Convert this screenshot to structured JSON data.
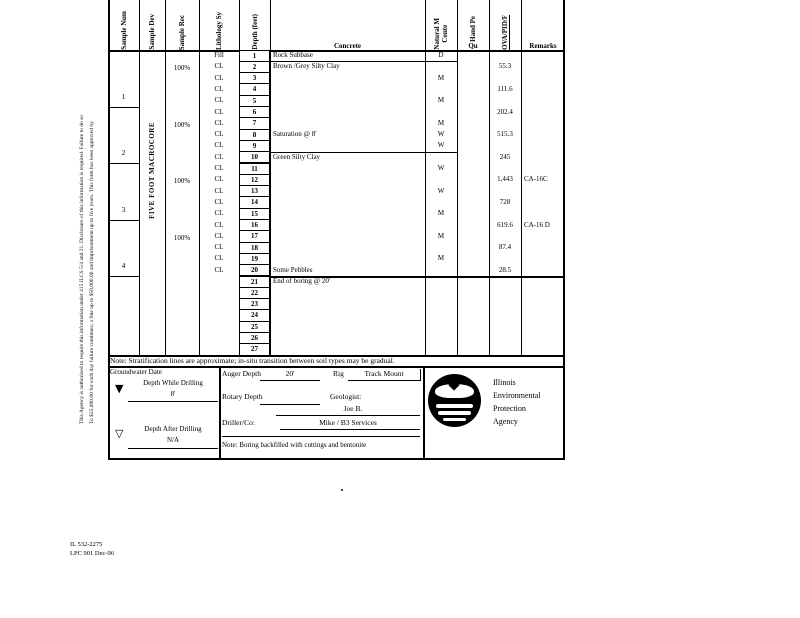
{
  "page": {
    "disclaimer_line1": "This Agency is authorized to require this information under 415 ILCS 5/4 and 21.  Disclosure of this information is required.  Failure to do so",
    "disclaimer_line2": "To $25,000.00 for each day failure continues; a fine up to $50,000.00 and imprisonment up to five years.  This form has been approved by",
    "footer_line1": "IL 532-2275",
    "footer_line2": "LPC 901 Dec-96"
  },
  "table": {
    "headers": {
      "sample_num": "Sample Num",
      "sample_dev": "Sample Dev",
      "sample_rec": "Sample Rec",
      "lithology": "Lithology Sy",
      "depth": "Depth (feet)",
      "surface_material": "Concrete",
      "moisture": "Natural M\nConte",
      "hand_pen": "Hand Pe",
      "qu": "Qu",
      "ova": "OVA/PID/F",
      "remarks": "Remarks"
    },
    "sample_dev_label": "FIVE FOOT MACROCORE",
    "samples": [
      {
        "num": "1",
        "rec": "100%",
        "start_row": 1,
        "end_row": 5
      },
      {
        "num": "2",
        "rec": "100%",
        "start_row": 6,
        "end_row": 10
      },
      {
        "num": "3",
        "rec": "100%",
        "start_row": 11,
        "end_row": 15
      },
      {
        "num": "4",
        "rec": "100%",
        "start_row": 16,
        "end_row": 20
      }
    ],
    "rows": [
      {
        "depth": "1",
        "lith": "Fill",
        "desc": "Rock Subbase",
        "moisture": "D",
        "ova": "",
        "remark": ""
      },
      {
        "depth": "2",
        "lith": "CL",
        "desc": "Brown /Grey Silty Clay",
        "moisture": "",
        "ova": "55.3",
        "remark": ""
      },
      {
        "depth": "3",
        "lith": "CL",
        "desc": "",
        "moisture": "M",
        "ova": "",
        "remark": ""
      },
      {
        "depth": "4",
        "lith": "CL",
        "desc": "",
        "moisture": "",
        "ova": "111.6",
        "remark": ""
      },
      {
        "depth": "5",
        "lith": "CL",
        "desc": "",
        "moisture": "M",
        "ova": "",
        "remark": ""
      },
      {
        "depth": "6",
        "lith": "CL",
        "desc": "",
        "moisture": "",
        "ova": "202.4",
        "remark": ""
      },
      {
        "depth": "7",
        "lith": "CL",
        "desc": "",
        "moisture": "M",
        "ova": "",
        "remark": ""
      },
      {
        "depth": "8",
        "lith": "CL",
        "desc": "Saturation @ 8'",
        "moisture": "W",
        "ova": "515.3",
        "remark": ""
      },
      {
        "depth": "9",
        "lith": "CL",
        "desc": "",
        "moisture": "W",
        "ova": "",
        "remark": ""
      },
      {
        "depth": "10",
        "lith": "CL",
        "desc": "Green Silty Clay",
        "moisture": "",
        "ova": "245",
        "remark": ""
      },
      {
        "depth": "11",
        "lith": "CL",
        "desc": "",
        "moisture": "W",
        "ova": "",
        "remark": ""
      },
      {
        "depth": "12",
        "lith": "CL",
        "desc": "",
        "moisture": "",
        "ova": "1,443",
        "remark": "CA-16C"
      },
      {
        "depth": "13",
        "lith": "CL",
        "desc": "",
        "moisture": "W",
        "ova": "",
        "remark": ""
      },
      {
        "depth": "14",
        "lith": "CL",
        "desc": "",
        "moisture": "",
        "ova": "728",
        "remark": ""
      },
      {
        "depth": "15",
        "lith": "CL",
        "desc": "",
        "moisture": "M",
        "ova": "",
        "remark": ""
      },
      {
        "depth": "16",
        "lith": "CL",
        "desc": "",
        "moisture": "",
        "ova": "619.6",
        "remark": "CA-16 D"
      },
      {
        "depth": "17",
        "lith": "CL",
        "desc": "",
        "moisture": "M",
        "ova": "",
        "remark": ""
      },
      {
        "depth": "18",
        "lith": "CL",
        "desc": "",
        "moisture": "",
        "ova": "87.4",
        "remark": ""
      },
      {
        "depth": "19",
        "lith": "CL",
        "desc": "",
        "moisture": "M",
        "ova": "",
        "remark": ""
      },
      {
        "depth": "20",
        "lith": "CL",
        "desc": "Some Pebbles",
        "moisture": "",
        "ova": "28.5",
        "remark": ""
      },
      {
        "depth": "21",
        "lith": "",
        "desc": "End of boring @ 20'",
        "moisture": "",
        "ova": "",
        "remark": ""
      },
      {
        "depth": "22",
        "lith": "",
        "desc": "",
        "moisture": "",
        "ova": "",
        "remark": ""
      },
      {
        "depth": "23",
        "lith": "",
        "desc": "",
        "moisture": "",
        "ova": "",
        "remark": ""
      },
      {
        "depth": "24",
        "lith": "",
        "desc": "",
        "moisture": "",
        "ova": "",
        "remark": ""
      },
      {
        "depth": "25",
        "lith": "",
        "desc": "",
        "moisture": "",
        "ova": "",
        "remark": ""
      },
      {
        "depth": "26",
        "lith": "",
        "desc": "",
        "moisture": "",
        "ova": "",
        "remark": ""
      },
      {
        "depth": "27",
        "lith": "",
        "desc": "",
        "moisture": "",
        "ova": "",
        "remark": ""
      }
    ],
    "strata_lines_after_rows": [
      1,
      9
    ],
    "end_of_boring_after_row": 20,
    "note": "Note: Stratification lines are approximate; in-situ transition between soil types may be gradual."
  },
  "groundwater": {
    "title": "Groundwater Date",
    "while_drilling_label": "Depth While Drilling",
    "while_drilling_value": "8'",
    "after_drilling_label": "Depth After Drilling",
    "after_drilling_value": "N/A"
  },
  "drilling": {
    "auger_label": "Auger Depth",
    "auger_value": "20'",
    "rig_label": "Rig",
    "rig_value": "Track Mount",
    "rotary_label": "Rotary Depth",
    "rotary_value": "",
    "geologist_label": "Geologist:",
    "geologist_value": "Joe B.",
    "driller_label": "Driller/Co:",
    "driller_value": "Mike / B3 Services",
    "backfill_note": "Note: Boring backfilled with cuttings and bentonite"
  },
  "agency": {
    "line1": "Illinois",
    "line2": "Environmental",
    "line3": "Protection",
    "line4": "Agency"
  }
}
